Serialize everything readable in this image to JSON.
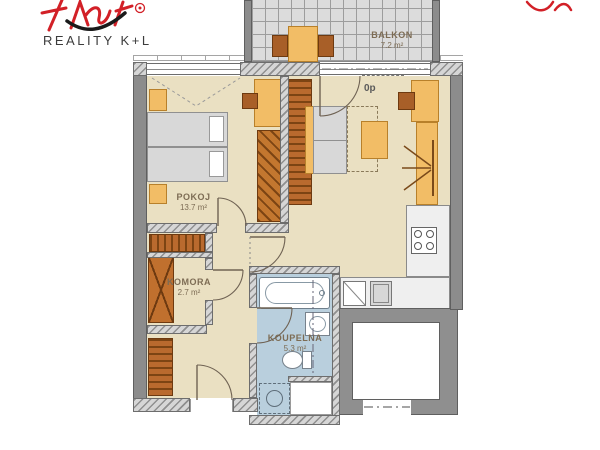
{
  "logo": {
    "brand": "REALITY K+L",
    "registered_mark": "®"
  },
  "labels": {
    "balkon": {
      "name": "BALKON",
      "area": "7.2 m²"
    },
    "pokoj": {
      "name": "POKOJ",
      "area": "13.7 m²"
    },
    "komora": {
      "name": "KOMORA",
      "area": "2.7 m²"
    },
    "koupelna": {
      "name": "KOUPELNA",
      "area": "5.3 m²"
    },
    "floor_label": "0p"
  },
  "colors": {
    "floor_beige": "#eae0c2",
    "bathroom_blue": "#b9cfdd",
    "furniture_orange": "#f2bd66",
    "furniture_brown": "#a85f28",
    "wall_grey": "#8c8c8c",
    "balcony_tile_grey": "#dcdcdc",
    "logo_red": "#d22027",
    "label_text": "#7d6c54"
  }
}
